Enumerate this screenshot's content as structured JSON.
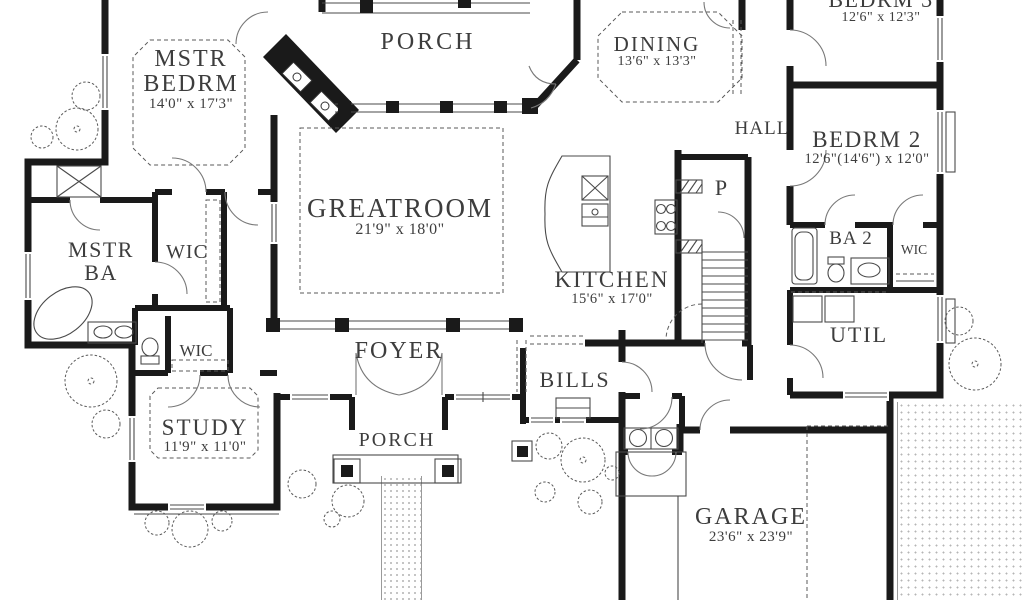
{
  "meta": {
    "type": "architectural first-floor plan",
    "background": "#ffffff"
  },
  "colors": {
    "wall": "#1a1a1a",
    "thin_line": "#4a4a4a",
    "text": "#3d3d3d",
    "stipple": "#b5b5b5"
  },
  "rooms": {
    "porch_top": {
      "label": "PORCH"
    },
    "dining": {
      "label": "DINING",
      "dims": "13'6\" x 13'3\""
    },
    "bedrm3": {
      "label": "BEDRM 3",
      "dims": "12'6\" x 12'3\""
    },
    "mstr_bedrm": {
      "line1": "MSTR",
      "line2": "BEDRM",
      "dims": "14'0\" x 17'3\""
    },
    "hall": {
      "label": "HALL"
    },
    "bedrm2": {
      "label": "BEDRM 2",
      "dims": "12'6\"(14'6\") x 12'0\""
    },
    "greatroom": {
      "label": "GREATROOM",
      "dims": "21'9\" x 18'0\""
    },
    "mstr_ba": {
      "line1": "MSTR",
      "line2": "BA"
    },
    "wic_master_upper": {
      "label": "WIC"
    },
    "kitchen": {
      "label": "KITCHEN",
      "dims": "15'6\" x 17'0\""
    },
    "pantry": {
      "label": "P"
    },
    "ba2": {
      "label": "BA 2"
    },
    "wic_right": {
      "label": "WIC"
    },
    "util": {
      "label": "UTIL"
    },
    "foyer": {
      "label": "FOYER"
    },
    "bills": {
      "label": "BILLS"
    },
    "wic_master_lower": {
      "label": "WIC"
    },
    "study": {
      "label": "STUDY",
      "dims": "11'9\" x 11'0\""
    },
    "porch_bottom": {
      "label": "PORCH"
    },
    "garage": {
      "label": "GARAGE",
      "dims": "23'6\" x 23'9\""
    }
  }
}
